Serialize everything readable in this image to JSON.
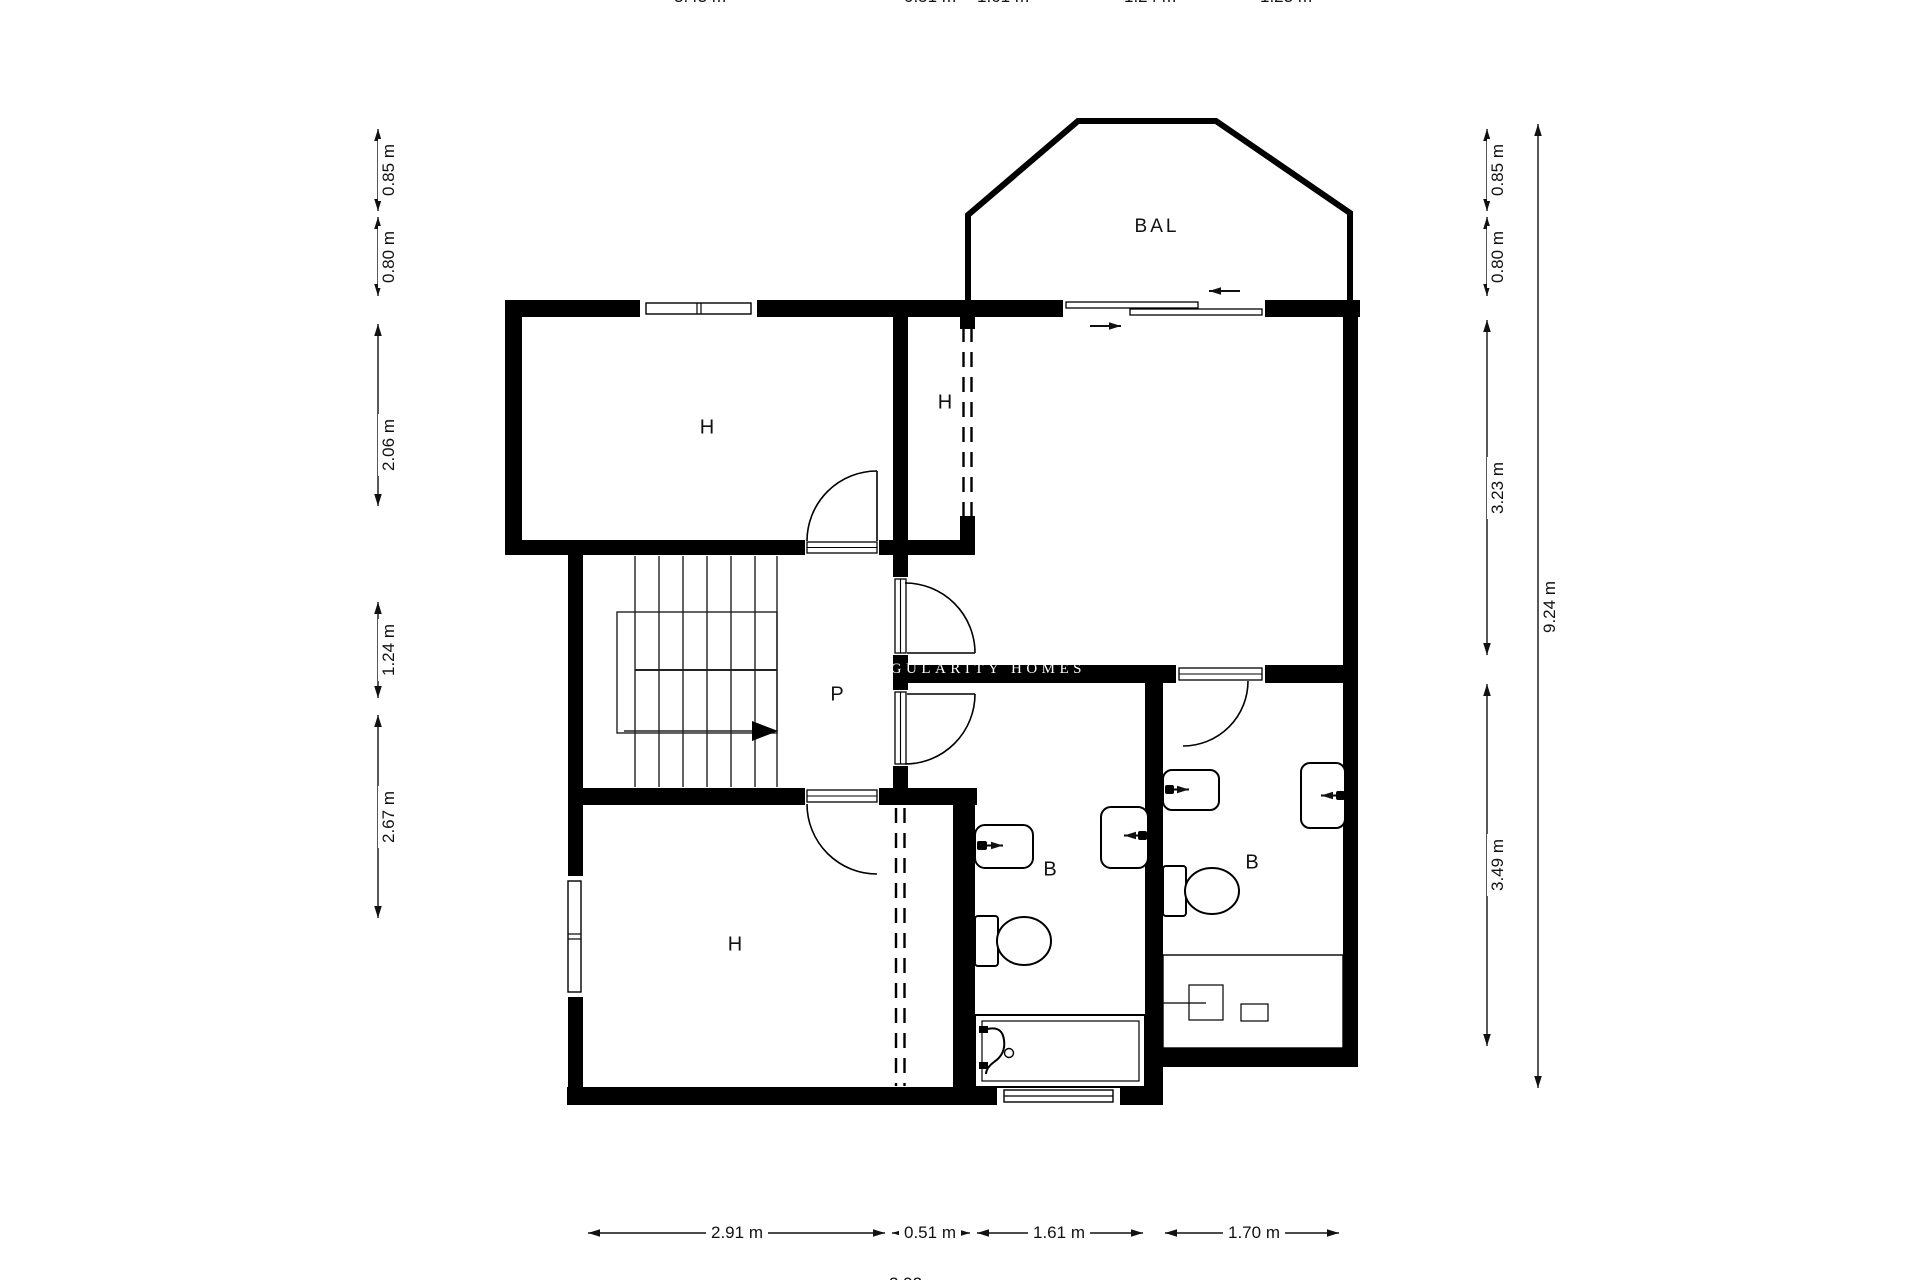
{
  "rooms": {
    "balcony": "BAL",
    "bedroom_top_left": "H",
    "bedroom_top_right": "H",
    "bedroom_bottom_left": "H",
    "hallway": "P",
    "bathroom_left": "B",
    "bathroom_right": "B"
  },
  "watermark": "SINGULARITY HOMES",
  "dimensions": {
    "left": [
      {
        "label": "0.85 m"
      },
      {
        "label": "0.80 m"
      },
      {
        "label": "2.06 m"
      },
      {
        "label": "1.24 m"
      },
      {
        "label": "2.67 m"
      }
    ],
    "right_inner": [
      {
        "label": "0.85 m"
      },
      {
        "label": "0.80 m"
      },
      {
        "label": "3.23 m"
      },
      {
        "label": "3.49 m"
      }
    ],
    "right_total": "9.24 m",
    "bottom": [
      {
        "label": "2.91 m"
      },
      {
        "label": "0.51 m"
      },
      {
        "label": "1.61 m"
      },
      {
        "label": "1.70 m"
      }
    ],
    "top_clipped": [
      {
        "label": "3.43 m"
      },
      {
        "label": "0.51 m"
      },
      {
        "label": "1.61 m"
      },
      {
        "label": "1.24 m"
      },
      {
        "label": "1.23 m"
      }
    ],
    "bottom_clipped": "2.92 m"
  },
  "colors": {
    "wall": "#000000",
    "background": "#ffffff",
    "line": "#1a1a1a"
  }
}
